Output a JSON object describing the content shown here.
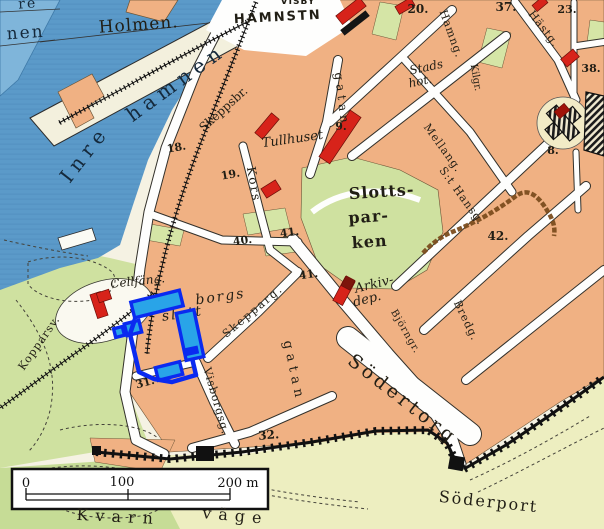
{
  "map": {
    "colors": {
      "water": "#5b9ac9",
      "water_light": "#7fb5da",
      "city_block": "#f0b183",
      "park_green": "#cfe1a0",
      "outside_wall": "#edeec0",
      "pier_cream": "#f3f0dd",
      "street_white": "#fefefd",
      "red_building": "#d7231a",
      "dark_red_building": "#8e170e",
      "wall_black": "#111111",
      "ruin_brown": "#7b4d1e",
      "annotation_stroke": "#0a2af0",
      "annotation_fill": "#29a4e8"
    },
    "labels": [
      {
        "id": "fragment-re",
        "text": "re",
        "x": 28,
        "y": 8,
        "rot": -4,
        "size": 14,
        "ls": 2,
        "style": "serif",
        "color": "#15293b"
      },
      {
        "id": "fragment-nen",
        "text": "nen",
        "x": 26,
        "y": 38,
        "rot": -4,
        "size": 17,
        "ls": 2,
        "style": "serif",
        "color": "#15293b"
      },
      {
        "id": "holmen",
        "text": "Holmen.",
        "x": 139,
        "y": 30,
        "rot": -4,
        "size": 17,
        "ls": 1,
        "style": "serif"
      },
      {
        "id": "visby-cut",
        "text": "VISBY",
        "x": 298,
        "y": 4,
        "rot": 0,
        "size": 9,
        "ls": 1,
        "style": "sans-bold"
      },
      {
        "id": "hamnstn",
        "text": "HAMNSTN",
        "x": 278,
        "y": 21,
        "rot": -3,
        "size": 13,
        "ls": 2,
        "style": "sans-bold"
      },
      {
        "id": "inre",
        "text": "Inre",
        "x": 90,
        "y": 158,
        "rot": -52,
        "size": 20,
        "ls": 6,
        "style": "serif",
        "color": "#15293b"
      },
      {
        "id": "hamnen",
        "text": "hamnen",
        "x": 180,
        "y": 88,
        "rot": -36,
        "size": 20,
        "ls": 6,
        "style": "serif",
        "color": "#15293b"
      },
      {
        "id": "skeppsbr-num",
        "text": "18.",
        "x": 177,
        "y": 151,
        "rot": -10,
        "size": 11,
        "style": "serif-bold"
      },
      {
        "id": "skeppsbr",
        "text": "Skeppsbr.",
        "x": 226,
        "y": 112,
        "rot": -42,
        "size": 12,
        "style": "serif"
      },
      {
        "id": "tullhuset",
        "text": "Tullhuset",
        "x": 293,
        "y": 143,
        "rot": -8,
        "size": 13,
        "style": "serif-italic"
      },
      {
        "id": "num-9",
        "text": "9.",
        "x": 341,
        "y": 130,
        "rot": 0,
        "size": 11,
        "style": "serif-bold"
      },
      {
        "id": "num-19",
        "text": "19.",
        "x": 231,
        "y": 178,
        "rot": -10,
        "size": 11,
        "style": "serif-bold"
      },
      {
        "id": "kors",
        "text": "Kors",
        "x": 250,
        "y": 185,
        "rot": 80,
        "size": 12,
        "ls": 2,
        "style": "serif"
      },
      {
        "id": "gatan-n",
        "text": "gatan",
        "x": 338,
        "y": 100,
        "rot": 83,
        "size": 12,
        "ls": 4,
        "style": "serif"
      },
      {
        "id": "slotts",
        "text": "Slotts-",
        "x": 382,
        "y": 197,
        "rot": -4,
        "size": 16,
        "ls": 1,
        "style": "serif-bold"
      },
      {
        "id": "par",
        "text": "par-",
        "x": 369,
        "y": 222,
        "rot": -4,
        "size": 16,
        "ls": 1,
        "style": "serif-bold"
      },
      {
        "id": "ken",
        "text": "ken",
        "x": 370,
        "y": 247,
        "rot": -4,
        "size": 16,
        "ls": 1,
        "style": "serif-bold"
      },
      {
        "id": "num-40",
        "text": "40.",
        "x": 243,
        "y": 244,
        "rot": -8,
        "size": 11,
        "style": "serif-bold"
      },
      {
        "id": "num-41a",
        "text": "41.",
        "x": 290,
        "y": 236,
        "rot": -8,
        "size": 11,
        "style": "serif-bold"
      },
      {
        "id": "num-41b",
        "text": "41.",
        "x": 309,
        "y": 278,
        "rot": -8,
        "size": 11,
        "style": "serif-bold"
      },
      {
        "id": "arkiv",
        "text": "Arkiv-",
        "x": 375,
        "y": 288,
        "rot": -14,
        "size": 13,
        "style": "serif-italic"
      },
      {
        "id": "dep",
        "text": "dep.",
        "x": 368,
        "y": 303,
        "rot": -14,
        "size": 13,
        "style": "serif-italic"
      },
      {
        "id": "stads",
        "text": "Stads",
        "x": 427,
        "y": 71,
        "rot": -12,
        "size": 12,
        "style": "serif-italic"
      },
      {
        "id": "hot",
        "text": "hot.",
        "x": 421,
        "y": 85,
        "rot": -12,
        "size": 12,
        "style": "serif-italic"
      },
      {
        "id": "hamng",
        "text": "Hamng.",
        "x": 448,
        "y": 35,
        "rot": 70,
        "size": 11,
        "ls": 1,
        "style": "serif"
      },
      {
        "id": "hastg",
        "text": "Hästg.",
        "x": 541,
        "y": 31,
        "rot": 52,
        "size": 11,
        "ls": 1,
        "style": "serif"
      },
      {
        "id": "kilgr",
        "text": "Kilgr.",
        "x": 473,
        "y": 78,
        "rot": 80,
        "size": 10,
        "style": "serif"
      },
      {
        "id": "num-20",
        "text": "20.",
        "x": 418,
        "y": 13,
        "rot": 0,
        "size": 12,
        "style": "serif-bold"
      },
      {
        "id": "num-37",
        "text": "37.",
        "x": 506,
        "y": 11,
        "rot": 0,
        "size": 12,
        "style": "serif-bold"
      },
      {
        "id": "num-23",
        "text": "23.",
        "x": 567,
        "y": 13,
        "rot": 0,
        "size": 11,
        "style": "serif-bold"
      },
      {
        "id": "num-38",
        "text": "38.",
        "x": 591,
        "y": 72,
        "rot": 0,
        "size": 11,
        "style": "serif-bold"
      },
      {
        "id": "mellang",
        "text": "Mellang.",
        "x": 440,
        "y": 150,
        "rot": 54,
        "size": 11,
        "ls": 1,
        "style": "serif"
      },
      {
        "id": "st-hansg",
        "text": "S:t Hansg.",
        "x": 459,
        "y": 198,
        "rot": 54,
        "size": 11,
        "ls": 1,
        "style": "serif"
      },
      {
        "id": "num-42",
        "text": "42.",
        "x": 498,
        "y": 240,
        "rot": 0,
        "size": 12,
        "style": "serif-bold"
      },
      {
        "id": "num-8",
        "text": "8.",
        "x": 553,
        "y": 154,
        "rot": 0,
        "size": 11,
        "style": "serif-bold"
      },
      {
        "id": "bredg",
        "text": "Bredg.",
        "x": 463,
        "y": 322,
        "rot": 64,
        "size": 11,
        "ls": 1,
        "style": "serif"
      },
      {
        "id": "bjorngr",
        "text": "Björngr.",
        "x": 403,
        "y": 333,
        "rot": 60,
        "size": 10,
        "ls": 1,
        "style": "serif"
      },
      {
        "id": "sodertorg",
        "text": "Södertorg",
        "x": 399,
        "y": 404,
        "rot": 38,
        "size": 19,
        "ls": 4,
        "style": "serif"
      },
      {
        "id": "soderport",
        "text": "Söderport",
        "x": 488,
        "y": 507,
        "rot": 6,
        "size": 16,
        "ls": 2,
        "style": "serif"
      },
      {
        "id": "num-31",
        "text": "31.",
        "x": 146,
        "y": 386,
        "rot": -15,
        "size": 11,
        "style": "serif-bold"
      },
      {
        "id": "num-32",
        "text": "32.",
        "x": 269,
        "y": 439,
        "rot": -5,
        "size": 12,
        "style": "serif-bold"
      },
      {
        "id": "visborgsg",
        "text": "Visborgsg.",
        "x": 213,
        "y": 402,
        "rot": 74,
        "size": 11,
        "ls": 1,
        "style": "serif"
      },
      {
        "id": "gatan-s",
        "text": "gatan",
        "x": 290,
        "y": 372,
        "rot": 78,
        "size": 13,
        "ls": 5,
        "style": "serif"
      },
      {
        "id": "skepparg",
        "text": "Skepparg.",
        "x": 255,
        "y": 314,
        "rot": -40,
        "size": 11,
        "ls": 2,
        "style": "serif"
      },
      {
        "id": "cellfang",
        "text": "Cellfäng.",
        "x": 138,
        "y": 285,
        "rot": -6,
        "size": 12,
        "style": "serif-italic"
      },
      {
        "id": "borgs",
        "text": "borgs",
        "x": 221,
        "y": 301,
        "rot": -8,
        "size": 14,
        "ls": 2,
        "style": "serif-italic"
      },
      {
        "id": "slott",
        "text": "slott",
        "x": 183,
        "y": 318,
        "rot": -8,
        "size": 14,
        "ls": 2,
        "style": "serif-italic"
      },
      {
        "id": "kopparsv",
        "text": "Kopparsv.",
        "x": 42,
        "y": 345,
        "rot": -55,
        "size": 11,
        "ls": 1,
        "style": "serif"
      },
      {
        "id": "kvarn",
        "text": "Kvarn",
        "x": 118,
        "y": 522,
        "rot": 3,
        "size": 16,
        "ls": 7,
        "style": "serif"
      },
      {
        "id": "vage",
        "text": "väge",
        "x": 235,
        "y": 521,
        "rot": 5,
        "size": 16,
        "ls": 7,
        "style": "serif"
      }
    ],
    "scale_bar": {
      "tick_0": "0",
      "tick_100": "100",
      "tick_200": "200 m"
    },
    "annotation": {
      "stroke": "#0a2af0",
      "fill": "#29a4e8",
      "shapes": [
        {
          "type": "rect",
          "cx": 157,
          "cy": 304,
          "w": 50,
          "h": 16,
          "rot": -14
        },
        {
          "type": "rect",
          "cx": 190,
          "cy": 335,
          "w": 18,
          "h": 48,
          "rot": -12
        },
        {
          "type": "rect",
          "cx": 169,
          "cy": 371,
          "w": 25,
          "h": 13,
          "rot": -14
        },
        {
          "type": "rect",
          "cx": 133,
          "cy": 328,
          "w": 15,
          "h": 12,
          "rot": -14
        },
        {
          "type": "rect",
          "cx": 119,
          "cy": 332,
          "w": 9,
          "h": 9,
          "rot": -14
        },
        {
          "type": "bar",
          "cx": 191,
          "cy": 351,
          "w": 15,
          "h": 8,
          "rot": -12
        },
        {
          "type": "outline",
          "points": [
            [
              135,
              319
            ],
            [
              130,
              334
            ],
            [
              139,
              372
            ],
            [
              154,
              379
            ],
            [
              172,
              382
            ],
            [
              196,
              375
            ],
            [
              192,
              358
            ]
          ]
        }
      ]
    }
  }
}
